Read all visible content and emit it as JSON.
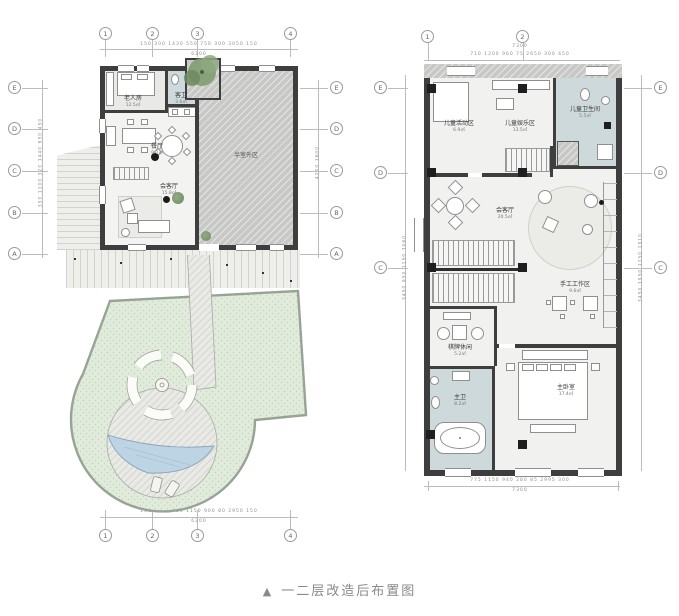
{
  "caption": {
    "marker": "▲",
    "title": "一二层改造后布置图"
  },
  "colors": {
    "wall": "#3e3e3e",
    "bath_floor": "#cdd9db",
    "semi_outdoor_hatch": "#c8c8c6",
    "garden_green": "#e1ebdb",
    "pool_blue": "#bdd4e5",
    "caption_gray": "#8a8a8a"
  },
  "plan_first_floor": {
    "grid": {
      "top": [
        "1",
        "2",
        "3",
        "4"
      ],
      "bottom": [
        "1",
        "2",
        "3",
        "4"
      ],
      "left": [
        "E",
        "D",
        "C",
        "B",
        "A"
      ],
      "right": [
        "E",
        "D",
        "C",
        "B",
        "A"
      ]
    },
    "dims": {
      "top_segments": [
        "150",
        "300",
        "1430",
        "550",
        "750",
        "300",
        "3050",
        "150"
      ],
      "top_total": "6200",
      "bottom_segments": [
        "150",
        "300",
        "1750",
        "1150",
        "900",
        "80",
        "2950",
        "150"
      ],
      "bottom_total": "6200",
      "left_segments": [
        "350",
        "1100",
        "320",
        "1440",
        "650",
        "450"
      ],
      "right_segments": [
        "4200",
        "1600"
      ]
    },
    "rooms": {
      "elder_bedroom": {
        "label": "老人房",
        "area": "12.5㎡"
      },
      "guest_bath": {
        "label": "客卫",
        "area": "3.6㎡"
      },
      "dining": {
        "label": "餐厅",
        "area": "9.2㎡"
      },
      "living": {
        "label": "会客厅",
        "area": "15.8㎡"
      },
      "semi_outdoor": {
        "label": "半室外区"
      }
    }
  },
  "plan_second_floor": {
    "grid": {
      "top": [
        "1",
        "2"
      ],
      "left": [
        "E",
        "D",
        "C"
      ],
      "right": [
        "E",
        "D",
        "C"
      ]
    },
    "dims": {
      "top_segments": [
        "710",
        "1200",
        "960",
        "75",
        "2650",
        "300",
        "450"
      ],
      "top_total": "7300",
      "bottom_segments": [
        "775",
        "1150",
        "940",
        "280",
        "85",
        "2995",
        "300"
      ],
      "bottom_total": "7300",
      "left_segments": [
        "3450",
        "950",
        "1150",
        "3060"
      ],
      "right_segments": [
        "3450",
        "1950",
        "1150",
        "1910"
      ]
    },
    "rooms": {
      "kids_activity": {
        "label": "儿童活动区",
        "area": "6.9㎡"
      },
      "kids_play": {
        "label": "儿童娱乐区",
        "area": "13.5㎡"
      },
      "kids_bath": {
        "label": "儿童卫生间",
        "area": "5.5㎡"
      },
      "family_room": {
        "label": "会客厅",
        "area": "20.5㎡"
      },
      "craft_area": {
        "label": "手工工作区",
        "area": "9.6㎡"
      },
      "leisure": {
        "label": "棋牌休闲",
        "area": "5.2㎡"
      },
      "master_bath": {
        "label": "主卫",
        "area": "8.2㎡"
      },
      "master_bedroom": {
        "label": "主卧室",
        "area": "17.4㎡"
      }
    }
  }
}
